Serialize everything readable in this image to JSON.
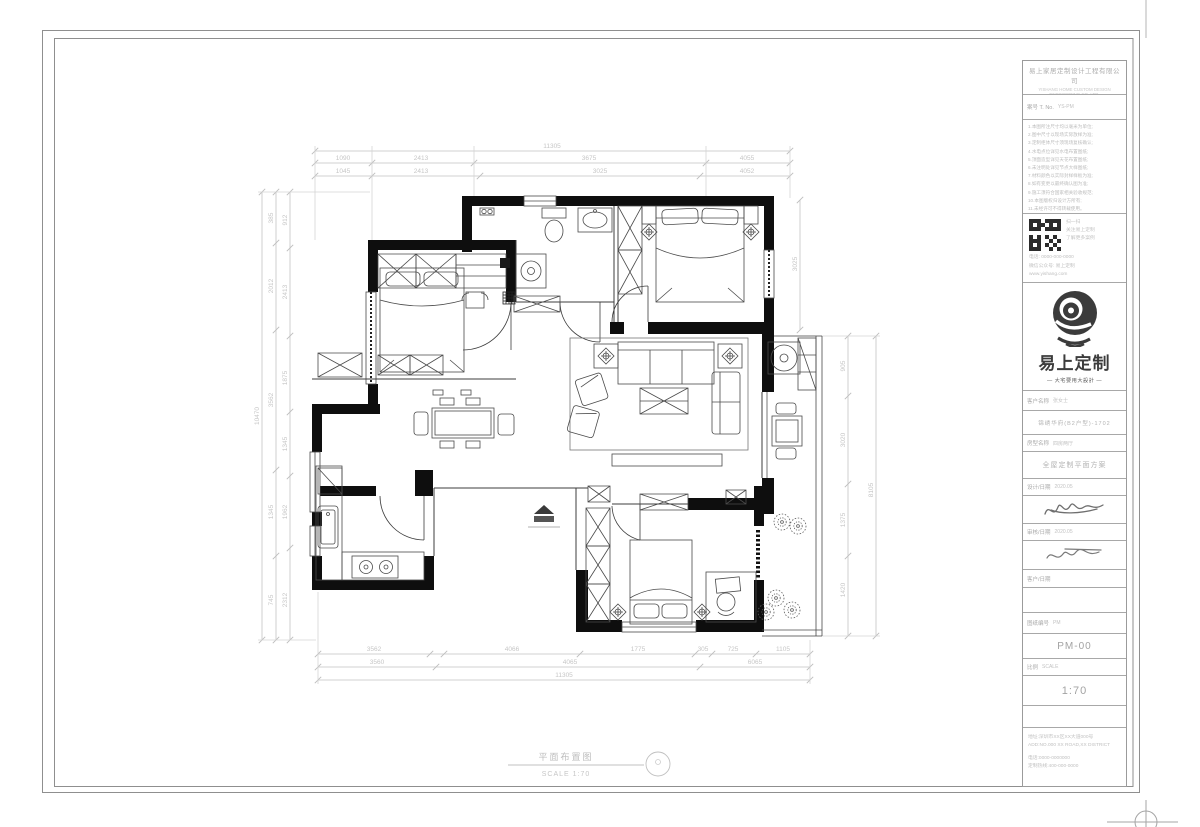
{
  "footer": {
    "drawing_title": "平面布置图",
    "scale_text": "SCALE 1:70"
  },
  "title_block": {
    "company_lines": [
      "易上家居定制设计工程有限公司",
      "YISHANG HOME CUSTOM DESIGN ENGINEERING CO.,LTD."
    ],
    "case_no_label": "案号 T. No.",
    "case_no_value": "YS-PM",
    "notes": [
      "1.本图所注尺寸均以毫米为单位;",
      "2.图中尺寸以现场实际放样为准;",
      "3.定制柜体尺寸须现场复核确认;",
      "4.水电点位详见水电布置图纸;",
      "5.顶面造型详见天花布置图纸;",
      "6.未注明处详见节点大样图纸;",
      "7.材料颜色以实际封样样板为准;",
      "8.如有变更以最终确认图为准;",
      "9.施工须符合国家相关验收规范;",
      "10.本图版权归设计方所有;",
      "11.未经许可不得转载使用。"
    ],
    "qr_caption": [
      "扫一扫",
      "关注易上定制",
      "了解更多案例"
    ],
    "qr_contact": [
      "电话: 0000-000-0000",
      "微信公众号: 易上定制",
      "www.yishang.com"
    ],
    "logo_name": "易上定制",
    "logo_tagline": "— 大宅要用大設計 —",
    "client_label": "客户名称",
    "client_value": "张女士",
    "project_name": "锦绣华府(B2户型)-1702",
    "type_label": "房型名称",
    "type_value": "四房两厅",
    "drawing_name": "全屋定制平面方案",
    "design_label": "设计/日期",
    "design_value": "2020.05",
    "audit_label": "审核/日期",
    "audit_value": "2020.05",
    "confirm_label": "客户/日期",
    "confirm_value": "",
    "drawing_no_label": "图纸编号",
    "drawing_no_hint": "PM",
    "drawing_no": "PM-00",
    "scale_label": "比例",
    "scale_hint": "SCALE",
    "scale_value": "1:70"
  },
  "dims": {
    "top_overall": "11305",
    "top_a": [
      "1090",
      "2413",
      "3675",
      "4055"
    ],
    "top_b": [
      "1045",
      "2413",
      "3025",
      "4052"
    ],
    "bottom_a": [
      "3562",
      "4066",
      "1775",
      "305",
      "725",
      "1105"
    ],
    "bottom_b": [
      "3560",
      "4065",
      "6065"
    ],
    "bottom_overall": "11305",
    "left_overall": "10470",
    "left_a": [
      "385",
      "2012",
      "3562",
      "1345",
      "745"
    ],
    "left_b": [
      "912",
      "2413",
      "1875",
      "1345",
      "1962",
      "2312"
    ],
    "right_a": [
      "905",
      "3020",
      "1375",
      "1420"
    ],
    "right_overall": "8105",
    "right_top": "3025"
  }
}
